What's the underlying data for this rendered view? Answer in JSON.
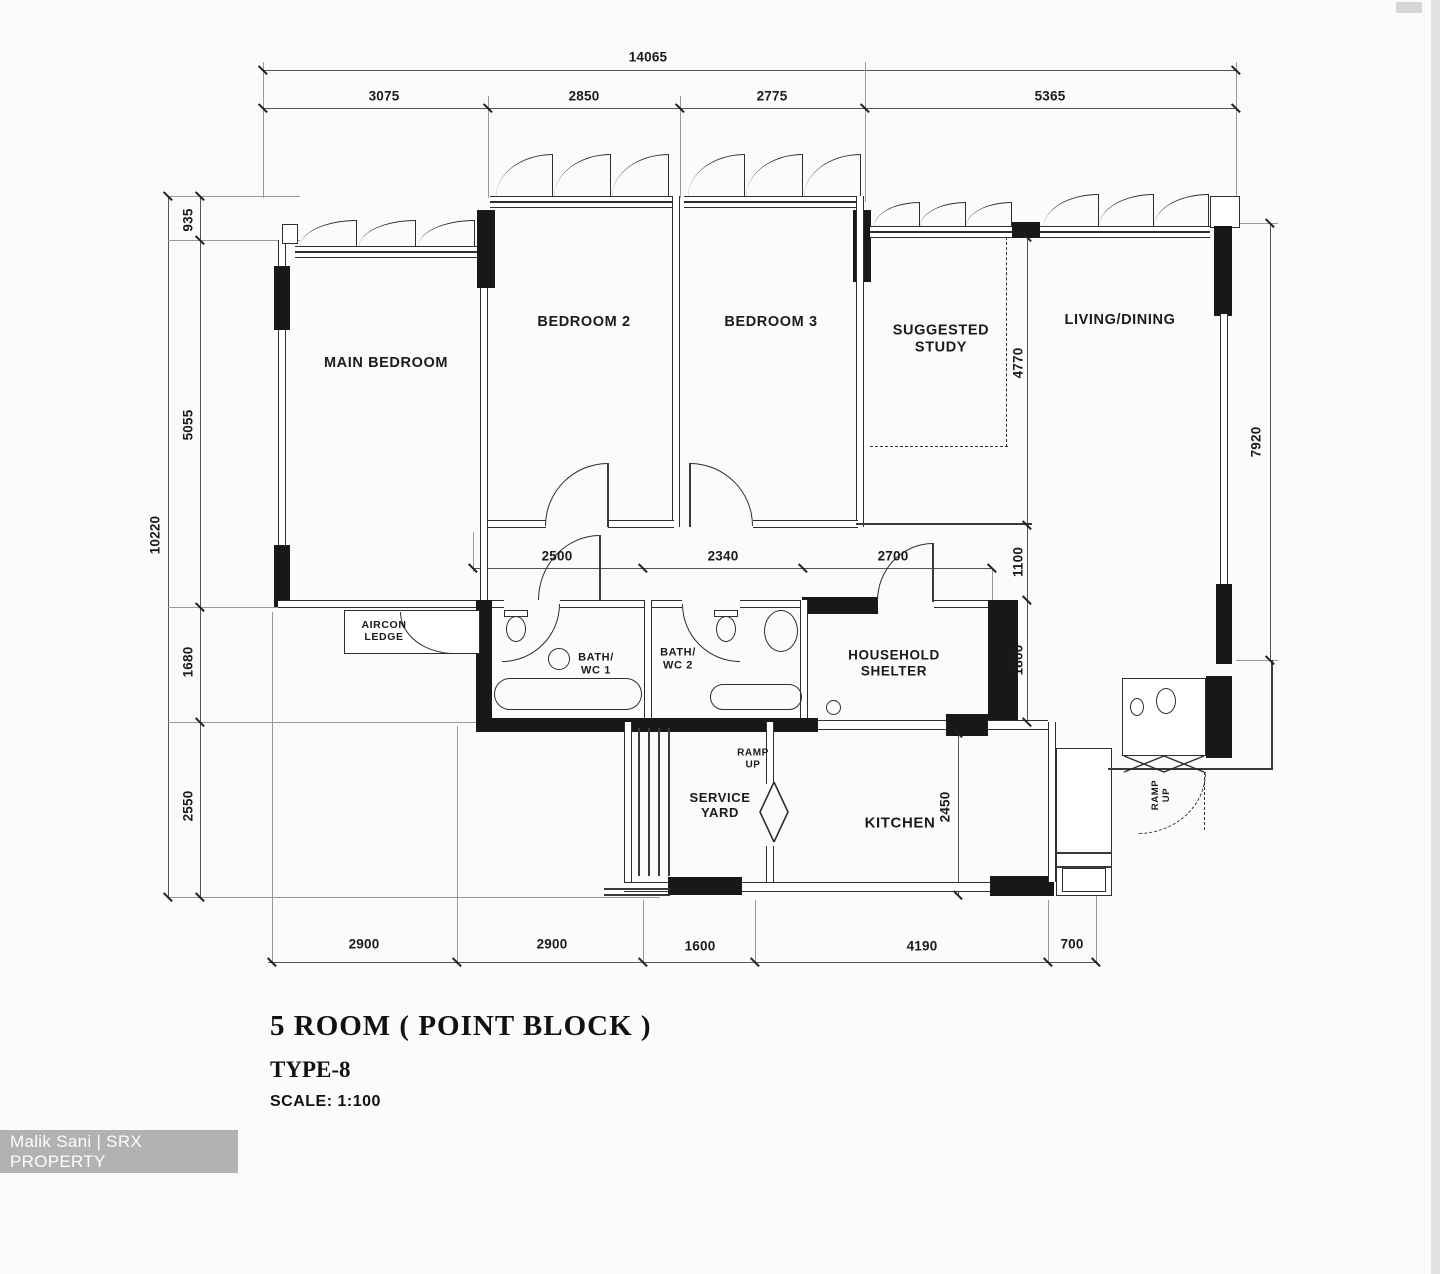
{
  "watermark": {
    "text": "Malik Sani | SRX PROPERTY"
  },
  "title_block": {
    "title": "5 ROOM ( POINT BLOCK )",
    "type": "TYPE-8",
    "scale": "SCALE: 1:100"
  },
  "rooms": {
    "main_bedroom": "MAIN BEDROOM",
    "bedroom2": "BEDROOM 2",
    "bedroom3": "BEDROOM 3",
    "suggested_study": "SUGGESTED STUDY",
    "living_dining": "LIVING/DINING",
    "aircon_ledge": "AIRCON LEDGE",
    "bath_wc_1": "BATH/ WC 1",
    "bath_wc_2": "BATH/ WC 2",
    "household_shelter": "HOUSEHOLD SHELTER",
    "service_yard": "SERVICE YARD",
    "kitchen": "KITCHEN",
    "ramp_up_service": "RAMP UP",
    "ramp_up_entrance": "RAMP UP"
  },
  "dimensions": {
    "top_overall": "14065",
    "top_segments": [
      "3075",
      "2850",
      "2775",
      "5365"
    ],
    "left_overall": "10220",
    "left_segments": [
      "935",
      "5055",
      "1680",
      "2550"
    ],
    "corridor_segments": [
      "2500",
      "2340",
      "2700"
    ],
    "right_segments": {
      "study_depth": "4770",
      "below_study": "1100",
      "shelter_depth": "1800",
      "living_edge": "7920",
      "kitchen_depth": "2450"
    },
    "bottom_segments": [
      "2900",
      "2900",
      "1600",
      "4190",
      "700"
    ]
  }
}
